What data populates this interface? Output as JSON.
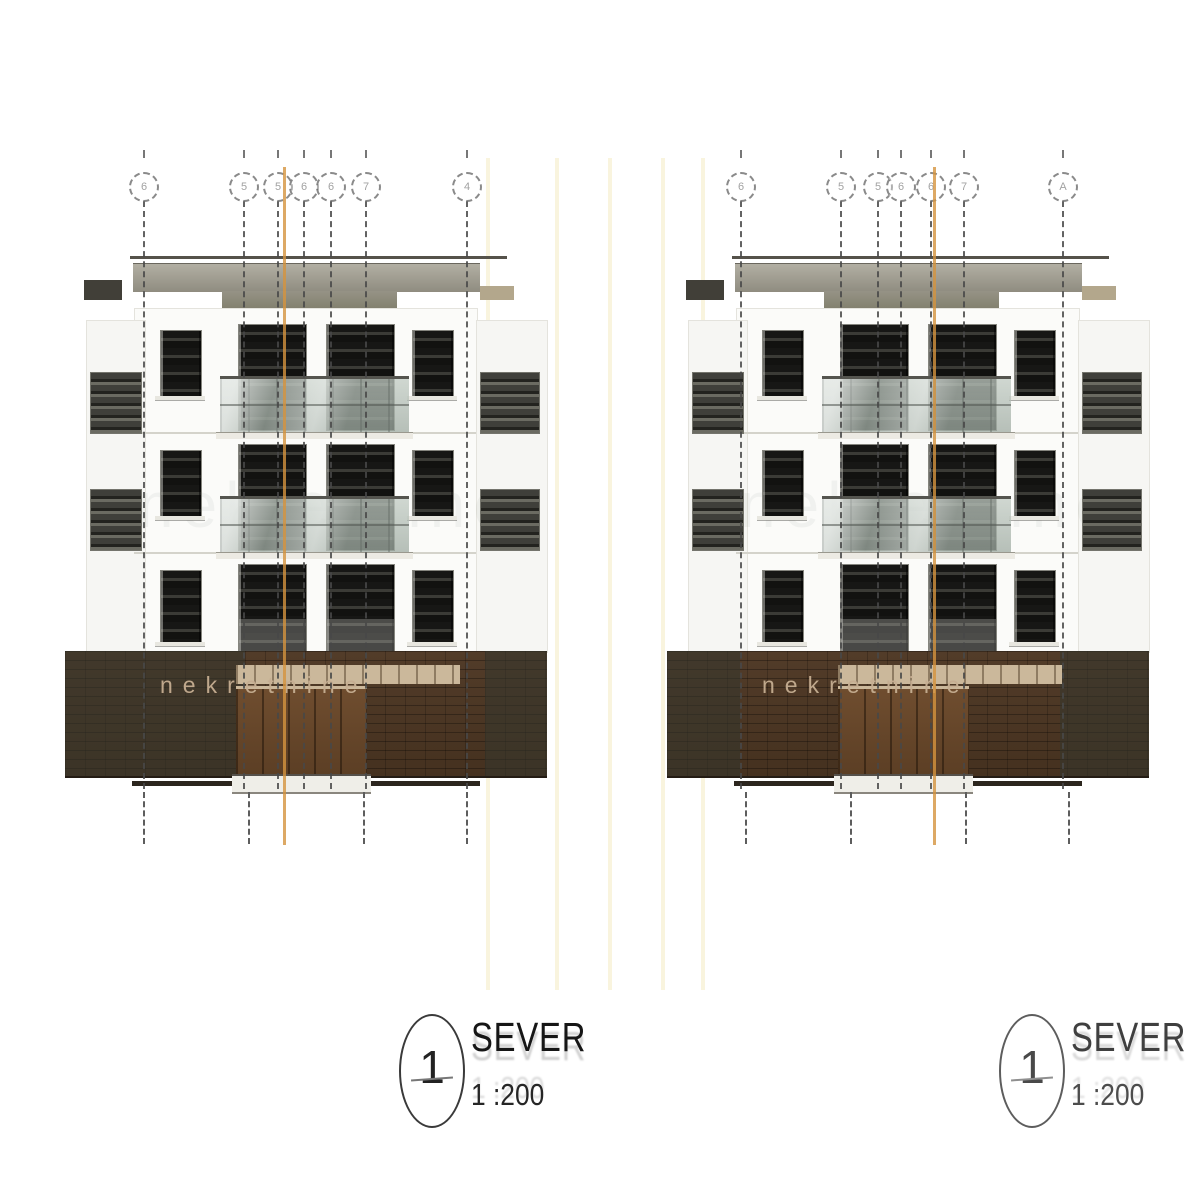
{
  "canvas": {
    "width": 1200,
    "height": 1184,
    "background": "#ffffff"
  },
  "drawing_type": "architectural elevation, two building views",
  "watermark": {
    "band_text": "nekretnine",
    "facade_ghost_text": "nekretnine"
  },
  "title_blocks": [
    {
      "number": "1",
      "label": "SEVER",
      "scale": "1 :200"
    },
    {
      "number": "1",
      "label": "SEVER",
      "scale": "1 :200"
    }
  ],
  "axes": {
    "left": {
      "xs": [
        143,
        243,
        277,
        303,
        330,
        365,
        466
      ],
      "labels": [
        "6",
        "5",
        "5",
        "6",
        "6",
        "7",
        "4"
      ]
    },
    "right": {
      "xs": [
        740,
        840,
        877,
        900,
        930,
        963,
        1062
      ],
      "labels": [
        "6",
        "5",
        "5",
        "6",
        "6",
        "7",
        "A"
      ]
    }
  },
  "gap_lines": [
    488,
    557,
    610,
    663,
    703
  ],
  "buildings": [
    {
      "side": "left",
      "x": 60,
      "orange_x": 283,
      "base_overlays": [
        [
          5,
          185
        ],
        [
          425,
          487
        ]
      ]
    },
    {
      "side": "right",
      "x": 662,
      "orange_x": 933,
      "base_overlays": [
        [
          5,
          78
        ],
        [
          398,
          487
        ]
      ]
    }
  ],
  "building_template": {
    "width": 488,
    "roof_line": {
      "x1": 70,
      "x2": 447,
      "y": 256,
      "h": 3
    },
    "band1": {
      "x1": 73,
      "x2": 420,
      "y1": 263,
      "y2": 291
    },
    "band2": {
      "x1": 162,
      "x2": 337,
      "y1": 291,
      "y2": 308
    },
    "facade": {
      "x1": 74,
      "x2": 416,
      "y1": 308,
      "y2": 651
    },
    "floor_lines": [
      432,
      552
    ],
    "wing_left": {
      "x1": 26,
      "x2": 84,
      "y1": 320,
      "y2": 651,
      "win_x1": 30,
      "win_x2": 80
    },
    "wing_right": {
      "x1": 416,
      "x2": 486,
      "y1": 320,
      "y2": 651,
      "win_x1": 420,
      "win_x2": 478
    },
    "wing_cap_left": {
      "x1": 24,
      "x2": 62,
      "y1": 280,
      "y2": 300
    },
    "wing_cap_right": {
      "x1": 420,
      "x2": 454,
      "y1": 286,
      "y2": 300
    },
    "wing_rows": [
      [
        372,
        432
      ],
      [
        489,
        549
      ]
    ],
    "small_cols": [
      [
        100,
        140
      ],
      [
        352,
        392
      ]
    ],
    "small_rows": [
      [
        330,
        396
      ],
      [
        450,
        516
      ],
      [
        570,
        642
      ]
    ],
    "large_cols": [
      [
        178,
        245
      ],
      [
        266,
        333
      ]
    ],
    "large_rows": [
      [
        324,
        429
      ],
      [
        444,
        549
      ],
      [
        564,
        651
      ]
    ],
    "railings": {
      "x1": 160,
      "x2": 349,
      "rows": [
        [
          376,
          431
        ],
        [
          496,
          551
        ]
      ]
    },
    "base": {
      "x1": 5,
      "x2": 487,
      "y1": 651,
      "y2": 776
    },
    "lintel": {
      "x1": 176,
      "x2": 400,
      "y1": 665,
      "y2": 684
    },
    "door": {
      "x1": 176,
      "x2": 307,
      "y1": 686,
      "y2": 776
    },
    "threshold": {
      "x1": 172,
      "x2": 311,
      "y1": 774,
      "y2": 790
    },
    "bottom_line": {
      "x1": 72,
      "x2": 420,
      "y": 781,
      "h": 5
    },
    "lower_dash_xs": [
      83,
      188,
      303,
      406
    ],
    "band_text_x": 100,
    "band_text_y": 672,
    "ghost_text_x": 78,
    "ghost_text_y": 468
  },
  "colors": {
    "roof_line": "#55524a",
    "roof_band_top": "#b2afa3",
    "roof_band_bot": "#8f8c80",
    "roof_band2_top": "#969386",
    "roof_band2_bot": "#83816f",
    "facade": "#fbfbf9",
    "facade_edge": "#e4e3dd",
    "facade_line": "#d4d3cb",
    "wing_fill": "#f6f6f3",
    "wing_cap_dark": "#413f38",
    "wing_cap_tan": "#b3a78c",
    "band_olive_overlay": "rgba(52,55,46,0.55)",
    "lintel": "#cbb89b",
    "door_top": "#6f4d2f",
    "door_bot": "#5b3e24",
    "threshold": "#efeee8",
    "orange": "rgba(213,147,62,0.8)",
    "faint_yellow": "#f6eecd",
    "title_text": "#161616"
  }
}
